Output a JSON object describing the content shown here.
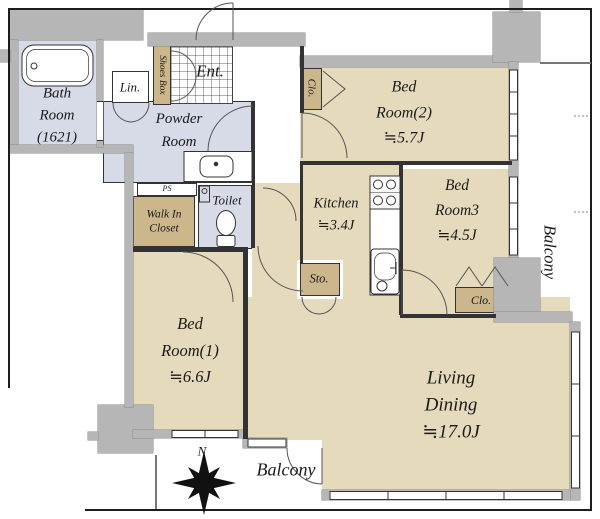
{
  "rooms": {
    "bath": {
      "name": "Bath\nRoom\n(1621)"
    },
    "powder": {
      "name": "Powder\nRoom"
    },
    "entrance": {
      "name": "Ent."
    },
    "toilet": {
      "name": "Toilet"
    },
    "kitchen": {
      "name": "Kitchen",
      "size": "≒3.4J"
    },
    "bedroom2": {
      "name": "Bed\nRoom(2)",
      "size": "≒5.7J"
    },
    "bedroom3": {
      "name": "Bed\nRoom3",
      "size": "≒4.5J"
    },
    "bedroom1": {
      "name": "Bed\nRoom(1)",
      "size": "≒6.6J"
    },
    "living": {
      "name": "Living\nDining",
      "size": "≒17.0J"
    },
    "balcony_right": {
      "name": "Balcony"
    },
    "balcony_bottom": {
      "name": "Balcony"
    }
  },
  "storage": {
    "lin": "Lin.",
    "shoes_box": "Shoes Box",
    "walk_in_closet": "Walk In\nCloset",
    "closet_bedroom2": "Clo.",
    "closet_bedroom3": "Clo.",
    "storage_living": "Sto.",
    "pipe_space": "PS"
  },
  "compass": {
    "north": "N"
  },
  "colors": {
    "room": "#e5dabc",
    "closet": "#ccb78c",
    "wet": "#d7dbe7",
    "wall": "#b6b6b6",
    "line": "#333333"
  }
}
